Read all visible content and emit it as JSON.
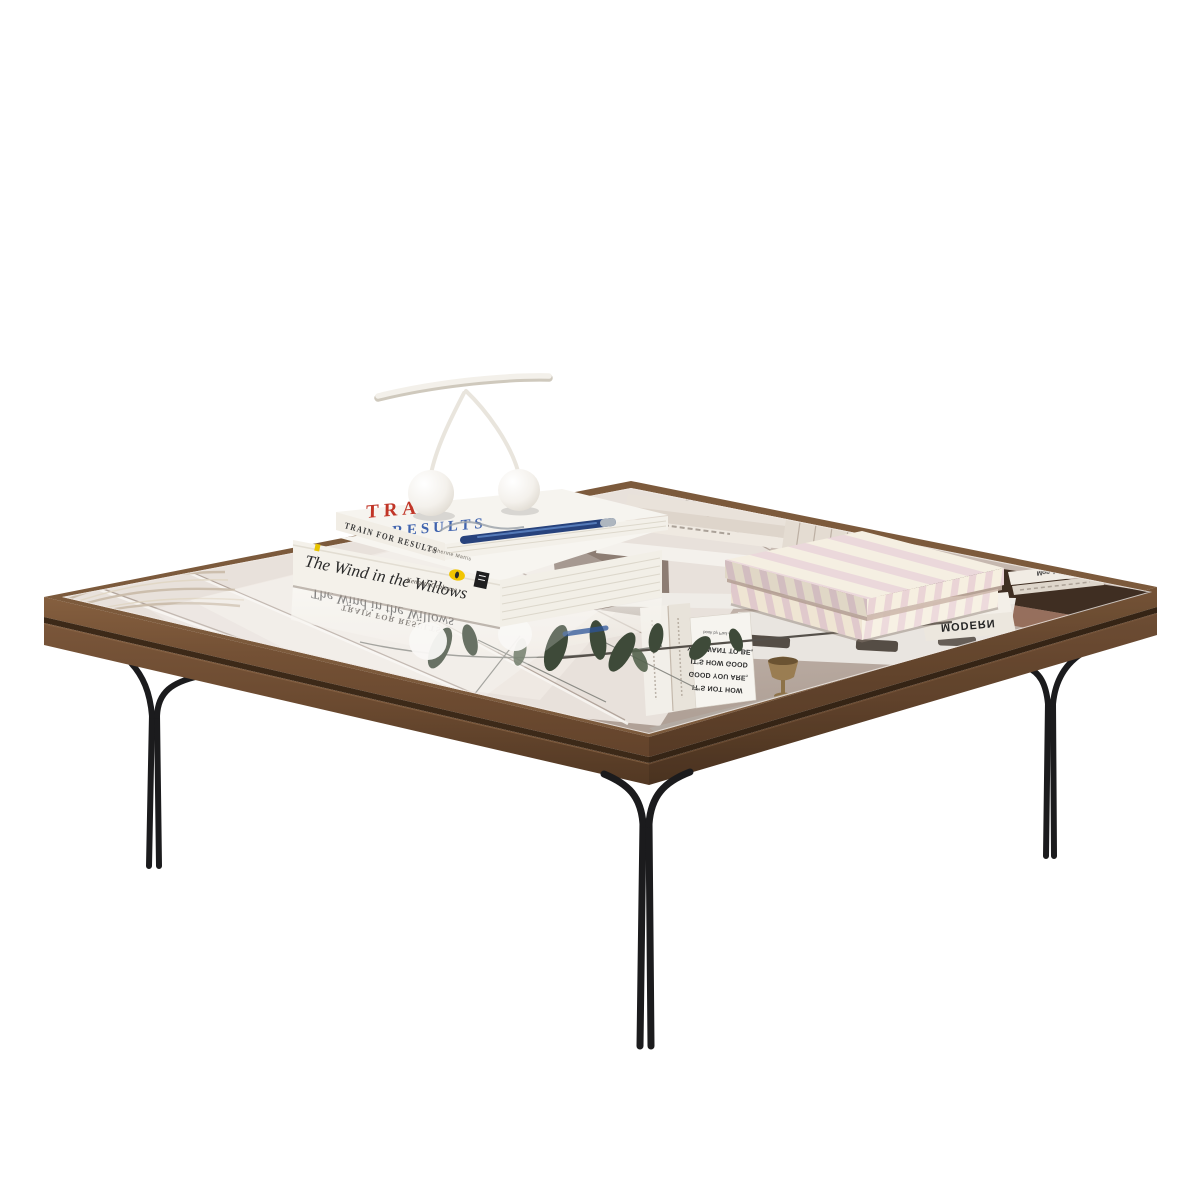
{
  "scene": {
    "description": "Square coffee table with mirrored glass top, walnut wood frame and black metal double-rod legs, styled with stacked books, a white ceramic cherry sculpture and a striped box",
    "background_color": "#ffffff"
  },
  "table": {
    "wood_color": "#6f4e34",
    "groove_color": "#3c2918",
    "leg_color": "#1b1b1d",
    "mirror_tint": "#c7bab1",
    "legs_visible": "3"
  },
  "books": {
    "train": {
      "spine_title": "TRAIN FOR RESULTS",
      "spine_author": "Catherine Mattis",
      "cover_line1": "TRAIN",
      "cover_line2": "RESULTS",
      "title_color": "#c13527",
      "accent_color": "#3f63ae",
      "pen_color": "#27427c"
    },
    "willows": {
      "spine_title": "The Wind in the Willows",
      "spine_author": "Kenneth Grahame",
      "logo_color": "#f2c500"
    }
  },
  "decor": {
    "cherries_color": "#f7f4ef",
    "box_stripe_color": "#e6cfd2",
    "box_base_color": "#f3ebdb"
  },
  "reflections": {
    "willows_title": "The Wind in the Willows",
    "train_title": "TRAIN FOR RESULTS",
    "modern_top": "MODERN",
    "modern_bottom": "MODERN",
    "mon_ami": "Mon Ami",
    "spine_fragment": "BETTER",
    "arden_line1": "YOU WANT TO BE,",
    "arden_line2": "IT'S HOW GOOD",
    "arden_line3": "GOOD YOU ARE,",
    "arden_line4": "IT'S NOT HOW",
    "arden_credit": "book by Paul Arden"
  }
}
